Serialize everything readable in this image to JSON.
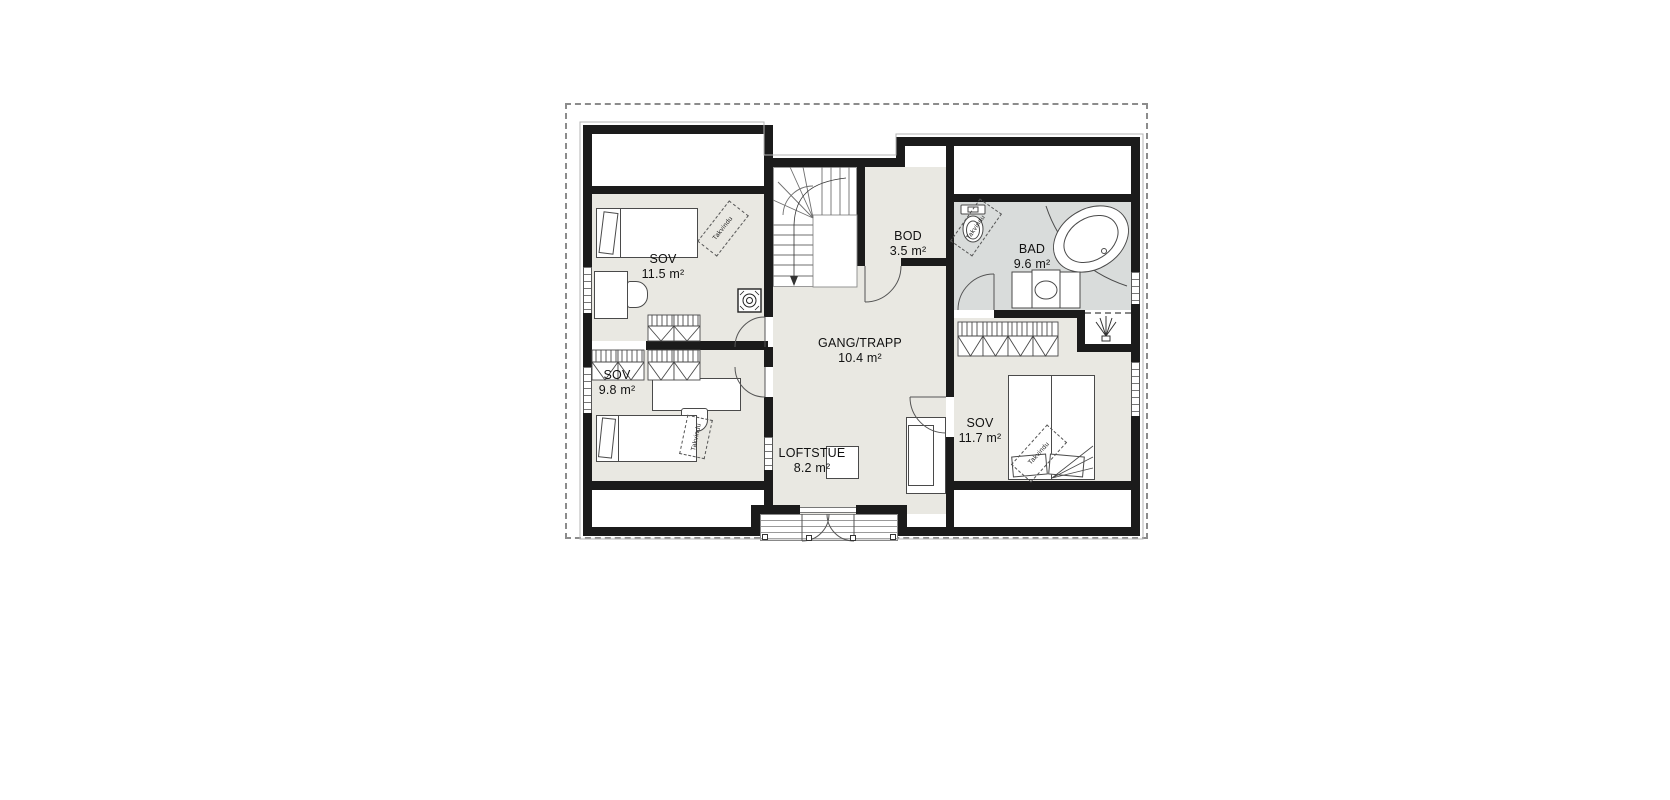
{
  "floorplan": {
    "rooms": [
      {
        "id": "sov-1",
        "name": "SOV",
        "area": "11.5 m²"
      },
      {
        "id": "sov-2",
        "name": "SOV",
        "area": "9.8 m²"
      },
      {
        "id": "bod",
        "name": "BOD",
        "area": "3.5 m²"
      },
      {
        "id": "bad",
        "name": "BAD",
        "area": "9.6 m²"
      },
      {
        "id": "gang",
        "name": "GANG/TRAPP",
        "area": "10.4 m²"
      },
      {
        "id": "sov-3",
        "name": "SOV",
        "area": "11.7 m²"
      },
      {
        "id": "loftstue",
        "name": "LOFTSTUE",
        "area": "8.2 m²"
      }
    ],
    "labels": {
      "skylight": "Takvindu"
    },
    "colors": {
      "room_fill": "#e9e8e2",
      "bath_fill": "#d9dcdb",
      "wall": "#1b1b1b",
      "boundary_dash": "#8c8c8c",
      "furniture_line": "#4a4a4a"
    }
  }
}
